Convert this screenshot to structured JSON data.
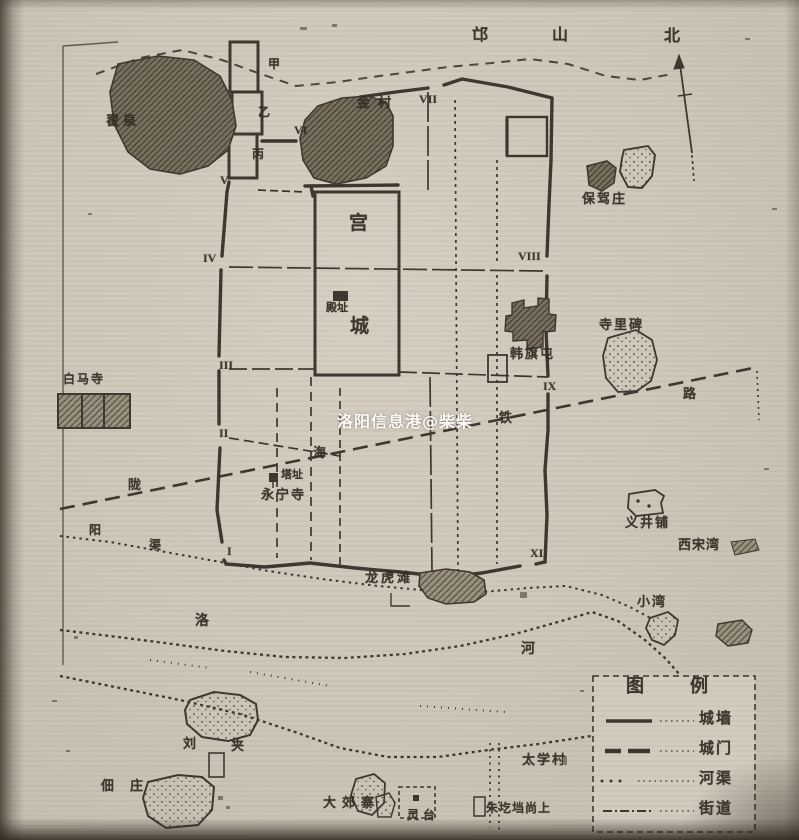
{
  "colors": {
    "paper": "#ccc5b7",
    "ink": "#3a332b",
    "hatch_fill": "#8f8676",
    "watermark": "#ffffff"
  },
  "watermark": {
    "text": "洛阳信息港@柴柴"
  },
  "compass": {
    "north": "北"
  },
  "mountain": {
    "char1": "邙",
    "char2": "山"
  },
  "city": {
    "palace_top": "宫",
    "palace_bottom": "城",
    "hall_site": "殿址",
    "enclosure_a": "甲",
    "enclosure_b": "乙",
    "enclosure_c": "丙",
    "gates": [
      "I",
      "II",
      "III",
      "IV",
      "V",
      "VI",
      "VII",
      "VIII",
      "IX",
      "XI"
    ]
  },
  "places": {
    "zhaiquan": "翟泉",
    "jincun": "金村",
    "baojiazhuang": "保驾庄",
    "hanqitun": "韩旗屯",
    "silibei": "寺里碑",
    "baimasi": "白马寺",
    "tazhi": "塔址",
    "yongningsi": "永宁寺",
    "longhutan": "龙虎滩",
    "yijingpu": "义井铺",
    "xisongwan": "西宋湾",
    "xiaowan": "小湾",
    "dianzhuang": "佃庄",
    "liu": "刘",
    "jia": "夹",
    "dajiaozhai": "大郊寨",
    "lingtai": "灵台",
    "zhugedang": "朱圪垱尚上",
    "taixuecun": "太学村"
  },
  "lines": {
    "railway": [
      "陇",
      "海",
      "铁",
      "路"
    ],
    "canal": [
      "阳",
      "渠"
    ],
    "river": [
      "洛",
      "河"
    ]
  },
  "legend": {
    "title": "图例",
    "items": [
      {
        "label": "城墙"
      },
      {
        "label": "城门"
      },
      {
        "label": "河渠"
      },
      {
        "label": "街道"
      }
    ]
  }
}
